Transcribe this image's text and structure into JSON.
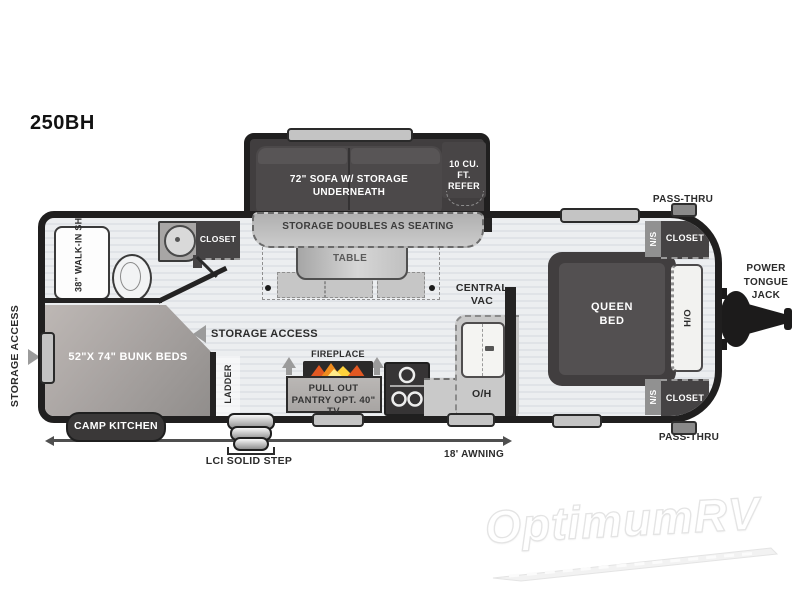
{
  "model": "250BH",
  "watermark": {
    "brand": "OptimumRV"
  },
  "colors": {
    "wall": "#201f1f",
    "furniture_dark": "#4c494a",
    "floor": "#eceef0",
    "floor_stripe": "#e0e3e7",
    "bunk_tan": "#b0aaa7",
    "counter_gray": "#c9c9c9",
    "label_dark": "#2b2b2b",
    "flame_orange": "#f08c1d",
    "flame_yellow": "#ffd23c"
  },
  "slide_out": {
    "sofa_label": "72\" SOFA W/ STORAGE UNDERNEATH",
    "refer_label": "10 CU. FT. REFER"
  },
  "dinette": {
    "seating_label": "STORAGE DOUBLES AS SEATING",
    "table_label": "TABLE"
  },
  "bathroom": {
    "shower_label": "38\" WALK-IN SHOWER",
    "closet_label": "CLOSET"
  },
  "bunk_room": {
    "bunk_label": "52\"X 74\" BUNK BEDS",
    "ladder_label": "LADDER",
    "storage_access_label": "STORAGE ACCESS",
    "camp_kitchen_label": "CAMP KITCHEN"
  },
  "kitchen": {
    "fireplace_label": "FIREPLACE",
    "pantry_label": "PULL OUT PANTRY OPT. 40\" TV",
    "overhead_label": "O/H",
    "central_vac_label": "CENTRAL VAC"
  },
  "bedroom": {
    "bed_label": "QUEEN BED",
    "ho_label": "H/O",
    "ns_top_label": "N/S",
    "closet_top_label": "CLOSET",
    "ns_bottom_label": "N/S",
    "closet_bottom_label": "CLOSET"
  },
  "exterior": {
    "storage_access_left_label": "STORAGE ACCESS",
    "pass_thru_top_label": "PASS-THRU",
    "pass_thru_bottom_label": "PASS-THRU",
    "power_tongue_jack_label": "POWER TONGUE JACK",
    "awning_label": "18' AWNING",
    "step_label": "LCI SOLID STEP"
  }
}
